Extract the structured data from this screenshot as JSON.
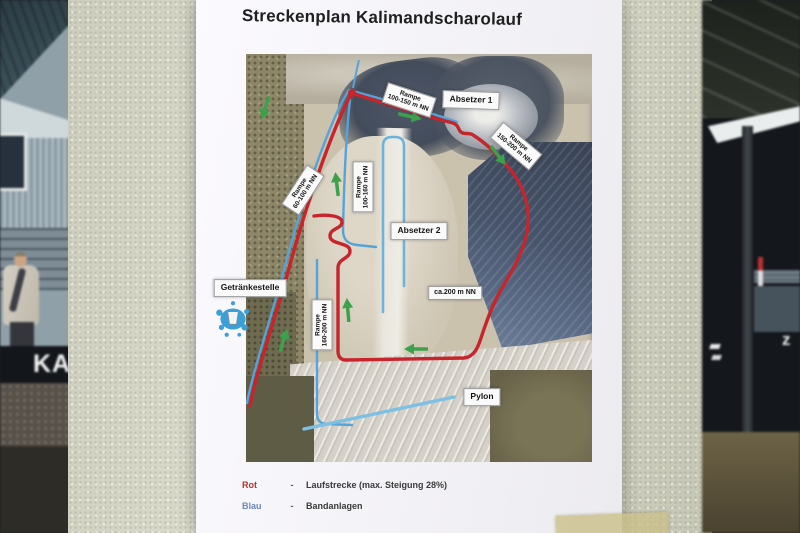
{
  "scene": {
    "banner_left_text": "KA",
    "banner_right_text": "z"
  },
  "poster": {
    "title": "Streckenplan Kalimandscharolauf",
    "colors": {
      "route_red": "#c8242b",
      "conveyor_blue": "#56a3d9",
      "conveyor_blue_light": "#7cc0e4",
      "arrow_green": "#3da04b"
    },
    "map_labels": {
      "rampe_100_150": {
        "line1": "Rampe",
        "line2": "100-150 m NN"
      },
      "absetzer1": {
        "text": "Absetzer 1"
      },
      "rampe_150_200": {
        "line1": "Rampe",
        "line2": "150-200 m NN"
      },
      "rampe_60_100": {
        "line1": "Rampe",
        "line2": "60-100 m NN"
      },
      "rampe_100_160": {
        "line1": "Rampe",
        "line2": "100-160 m NN"
      },
      "absetzer2": {
        "text": "Absetzer 2"
      },
      "getraenkestelle": {
        "text": "Getränkestelle"
      },
      "rampe_160_200": {
        "line1": "Rampe",
        "line2": "160-200 m NN"
      },
      "ca_200": {
        "text": "ca.200 m NN"
      },
      "pylon": {
        "text": "Pylon"
      }
    },
    "legend": {
      "rows": [
        {
          "name": "Rot",
          "dash": "-",
          "desc": "Laufstrecke (max. Steigung 28%)"
        },
        {
          "name": "Blau",
          "dash": "-",
          "desc": "Bandanlagen"
        }
      ]
    }
  }
}
